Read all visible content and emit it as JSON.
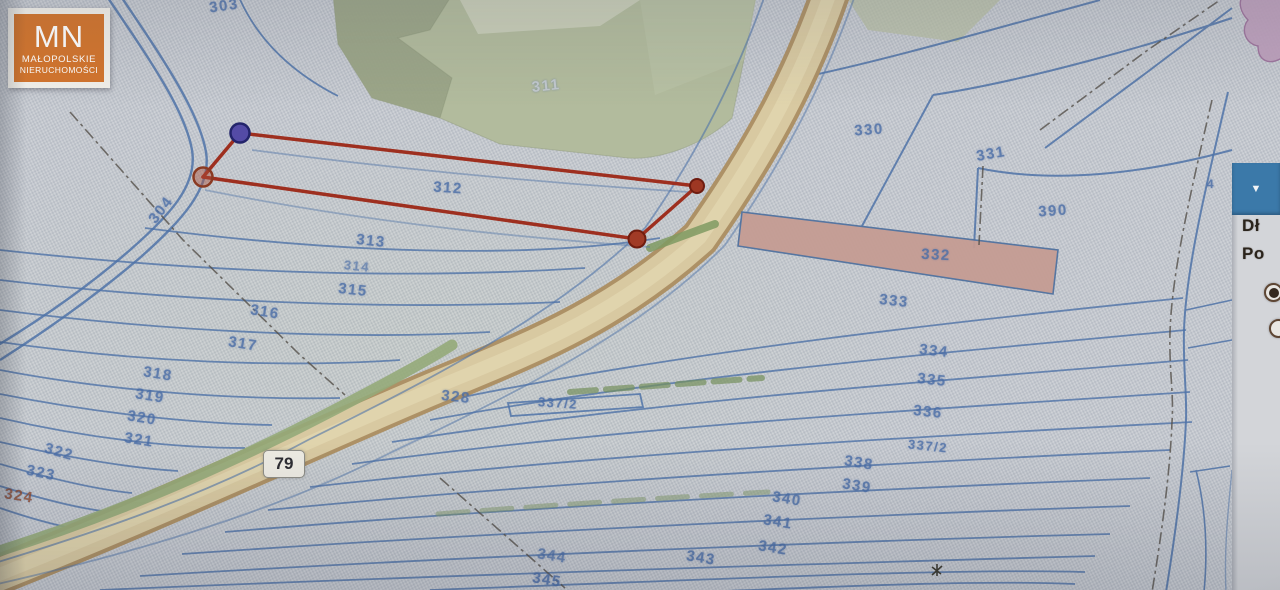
{
  "logo": {
    "initials": "MN",
    "line1": "MAŁOPOLSKIE",
    "line2": "NIERUCHOMOŚCI"
  },
  "road_badge": {
    "number": "79"
  },
  "panel": {
    "collapse_icon": "▼",
    "item1": "Dł",
    "item2": "Po",
    "radio1_selected": true,
    "radio2_selected": false
  },
  "map": {
    "selected_parcel": "312",
    "parcel_labels": [
      {
        "t": "303",
        "x": 224,
        "y": 6,
        "r": -8
      },
      {
        "t": "311",
        "x": 546,
        "y": 86,
        "r": -6,
        "c": "#c2c9d2",
        "o": 0.9
      },
      {
        "t": "304",
        "x": 161,
        "y": 210,
        "r": -52
      },
      {
        "t": "312",
        "x": 448,
        "y": 188,
        "r": 4
      },
      {
        "t": "313",
        "x": 371,
        "y": 241,
        "r": 6
      },
      {
        "t": "314",
        "x": 357,
        "y": 266,
        "r": 6,
        "s": 13,
        "o": 0.65
      },
      {
        "t": "315",
        "x": 353,
        "y": 290,
        "r": 6
      },
      {
        "t": "316",
        "x": 265,
        "y": 312,
        "r": 9
      },
      {
        "t": "317",
        "x": 243,
        "y": 344,
        "r": 9
      },
      {
        "t": "318",
        "x": 158,
        "y": 374,
        "r": 9
      },
      {
        "t": "319",
        "x": 150,
        "y": 396,
        "r": 9
      },
      {
        "t": "320",
        "x": 142,
        "y": 418,
        "r": 9
      },
      {
        "t": "321",
        "x": 139,
        "y": 440,
        "r": 9
      },
      {
        "t": "322",
        "x": 59,
        "y": 452,
        "r": 16
      },
      {
        "t": "323",
        "x": 41,
        "y": 473,
        "r": 12
      },
      {
        "t": "324",
        "x": 19,
        "y": 496,
        "r": 9,
        "c": "#8d4b32"
      },
      {
        "t": "328",
        "x": 456,
        "y": 397,
        "r": 6
      },
      {
        "t": "337/2",
        "x": 558,
        "y": 403,
        "r": 4,
        "s": 13
      },
      {
        "t": "330",
        "x": 869,
        "y": 130,
        "r": -4
      },
      {
        "t": "331",
        "x": 991,
        "y": 154,
        "r": -10
      },
      {
        "t": "390",
        "x": 1053,
        "y": 211,
        "r": -4
      },
      {
        "t": "332",
        "x": 936,
        "y": 255,
        "r": 3
      },
      {
        "t": "333",
        "x": 894,
        "y": 301,
        "r": 6
      },
      {
        "t": "334",
        "x": 934,
        "y": 351,
        "r": 6
      },
      {
        "t": "335",
        "x": 932,
        "y": 380,
        "r": 6
      },
      {
        "t": "336",
        "x": 928,
        "y": 412,
        "r": 6
      },
      {
        "t": "337/2",
        "x": 928,
        "y": 446,
        "r": 6,
        "s": 13
      },
      {
        "t": "338",
        "x": 859,
        "y": 463,
        "r": 9
      },
      {
        "t": "339",
        "x": 857,
        "y": 486,
        "r": 9
      },
      {
        "t": "340",
        "x": 787,
        "y": 499,
        "r": 9
      },
      {
        "t": "341",
        "x": 778,
        "y": 522,
        "r": 9
      },
      {
        "t": "342",
        "x": 773,
        "y": 548,
        "r": 9
      },
      {
        "t": "343",
        "x": 701,
        "y": 558,
        "r": 9
      },
      {
        "t": "344",
        "x": 552,
        "y": 556,
        "r": 9,
        "o": 0.75
      },
      {
        "t": "345",
        "x": 547,
        "y": 580,
        "r": 9,
        "o": 0.85
      },
      {
        "t": "4",
        "x": 1211,
        "y": 184,
        "r": 0,
        "s": 12
      }
    ]
  },
  "colors": {
    "logo_orange": "#d2742c",
    "parcel_line_blue": "#4f73a8",
    "label_blue": "#4a6da6",
    "label_brown": "#8d4b32",
    "selection_red": "#9e2f1f",
    "road_fill": "#d8c9a1",
    "road_edge": "#ad9166",
    "verge_green": "#95aa79",
    "forest_green": "#b2bb9d",
    "parcel_332_pink": "#c59c93",
    "panel_header_blue": "#3b79a9"
  }
}
